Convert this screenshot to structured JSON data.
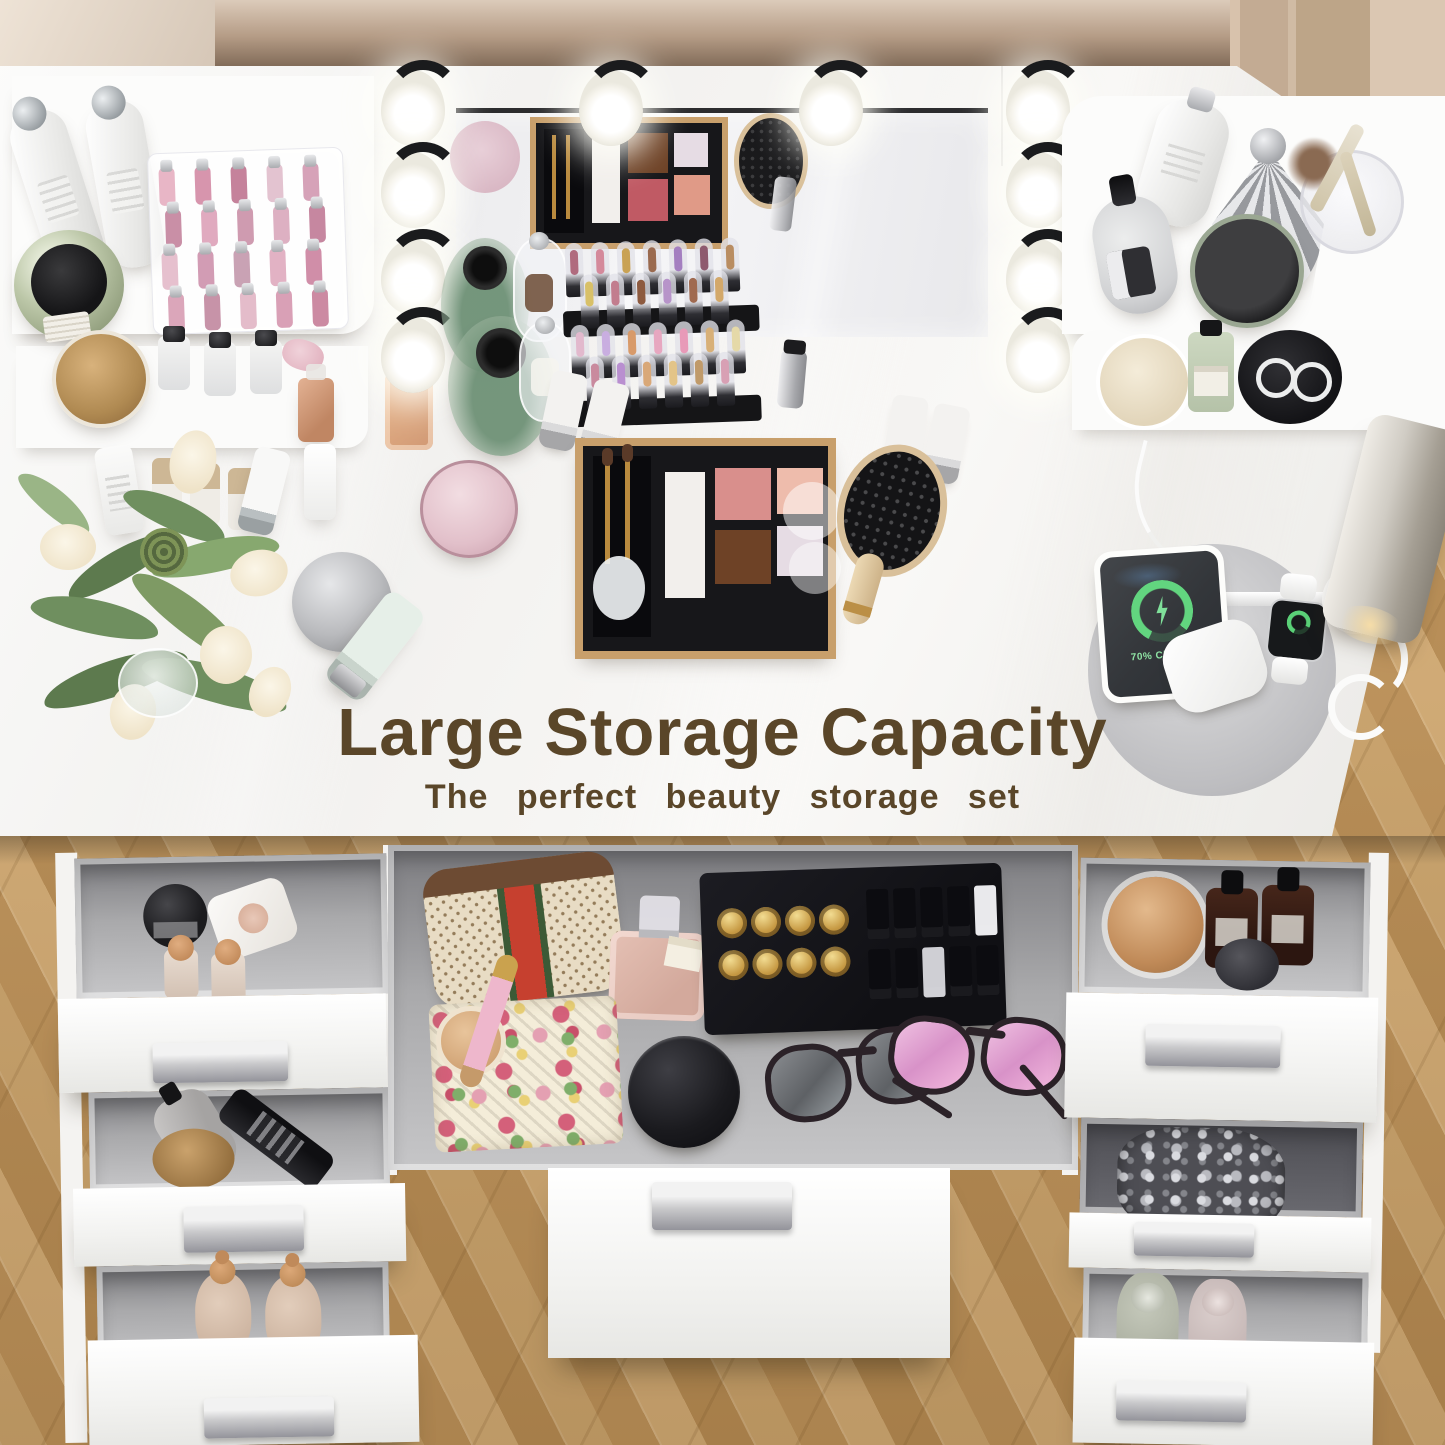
{
  "text": {
    "headline": "Large Storage Capacity",
    "subheadline": "The perfect beauty storage set"
  },
  "charging_station": {
    "phone_status": "70% Charged",
    "devices": [
      "phone",
      "smartwatch",
      "earbuds case"
    ]
  },
  "colors": {
    "headline_brown": "#5a4629",
    "desk_white": "#f6f5f3",
    "floor_wood": "#c59f6a",
    "wall_tan": "#b59c86",
    "drawer_interior_gray": "#97979a",
    "charge_green": "#62d57f",
    "palette_frame_gold": "#c89f6b"
  },
  "lights": {
    "bulb_count": 10
  },
  "palette_swatches": {
    "white": "#f2efec",
    "blush": "#d98f8c",
    "peach": "#eebcac",
    "bronze": "#6e4226",
    "lilac": "#e6dce4"
  },
  "lipgloss_colors": [
    "#e8b6c6",
    "#d795ad",
    "#c5829b",
    "#e3c3d0",
    "#d6a2b8",
    "#c98fa6",
    "#e0aabf",
    "#cf9bb0",
    "#ddb0c2",
    "#c687a0",
    "#e6c0ce",
    "#d29cb4",
    "#c9a2b4",
    "#e2b2c4",
    "#d08ea8",
    "#dba6ba",
    "#c793a8",
    "#e4bcca",
    "#d9a0b6",
    "#cc8aa2"
  ],
  "lipstick_rack_front": [
    "#b06b7e",
    "#d4899b",
    "#c9a254",
    "#9a6a4f",
    "#a47fc0",
    "#8e5a6e",
    "#b98d62",
    "#d8c068",
    "#c27d8e",
    "#8d5a3f",
    "#b794c9",
    "#a06a50",
    "#d3a86a"
  ],
  "lipstick_rack_back": [
    "#e2b9cd",
    "#c9aee0",
    "#d89a6a",
    "#e7a7c0",
    "#e89ab8",
    "#d8b078",
    "#e5d9a8",
    "#c98a9e",
    "#b98fd0",
    "#d9a878",
    "#e3c488",
    "#c09a6a",
    "#d8a0b4"
  ],
  "lipstick_set": {
    "gold_bullet_count": 8,
    "box_colors": [
      "#0c0c10",
      "#0c0c10",
      "#0c0c10",
      "#0c0c10",
      "#e9e9ec",
      "#0c0c10",
      "#0c0c10",
      "#cfcfd4",
      "#0c0c10",
      "#0c0c10"
    ]
  },
  "items": {
    "left_shelf": [
      "lotion bottles",
      "lip gloss organizer",
      "green jar",
      "wood-lid jar",
      "mini bottles",
      "ribbon",
      "perfume",
      "nail polishes",
      "tube",
      "dropper bottle"
    ],
    "desk_center": [
      "flower bouquet",
      "hand mirror",
      "mint tube",
      "pink jar",
      "makeup palette",
      "hair brush",
      "lipstick racks",
      "glass vases",
      "glass cloches",
      "squeeze tubes",
      "amber perfume",
      "vanity mirror"
    ],
    "right_shelf": [
      "pump bottle",
      "spray bottle",
      "shell comb",
      "brush cup",
      "powder puff",
      "green jar",
      "cream compact",
      "mini green bottle",
      "ring dish with rings"
    ],
    "drawers_left": [
      "black jar",
      "cream tube",
      "copper-cap sprays",
      "gray pump bottle",
      "black styling bottle",
      "wood-lid jar",
      "beige bottles"
    ],
    "drawers_center": [
      "monogram pouch",
      "pink perfume",
      "floral cloth",
      "compact",
      "pink lipstick pen",
      "lipstick gift set",
      "black jar",
      "gray sunglasses",
      "pink sunglasses"
    ],
    "drawers_right": [
      "copper-lid jar",
      "amber dropper bottles",
      "dark disc",
      "silver filigree piece",
      "green bottle",
      "pink bottle"
    ]
  }
}
